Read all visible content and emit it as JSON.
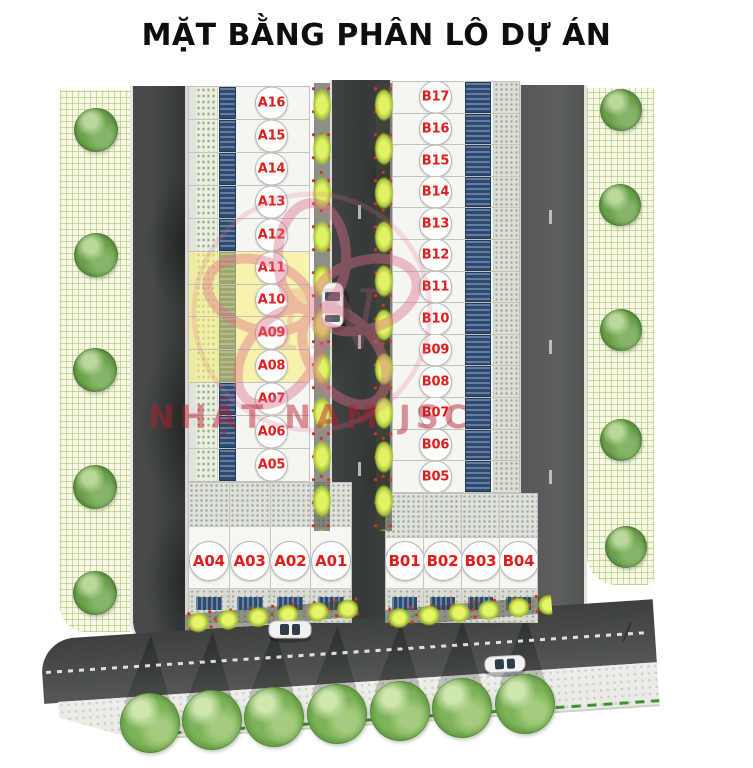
{
  "title": "MẶT BẰNG PHÂN LÔ DỰ ÁN",
  "watermark": {
    "text": "NHẬT NAM JSC",
    "monogram": "NN"
  },
  "blocks": {
    "block_a_column": {
      "lots": [
        "A16",
        "A15",
        "A14",
        "A13",
        "A12",
        "A11",
        "A10",
        "A09",
        "A08",
        "A07",
        "A06",
        "A05"
      ],
      "highlighted_lots": [
        "A11",
        "A10",
        "A09",
        "A08"
      ]
    },
    "block_a_row": {
      "lots": [
        "A04",
        "A03",
        "A02",
        "A01"
      ]
    },
    "block_b_column": {
      "lots": [
        "B17",
        "B16",
        "B15",
        "B14",
        "B13",
        "B12",
        "B11",
        "B10",
        "B09",
        "B08",
        "B07",
        "B06",
        "B05"
      ],
      "highlighted_lots": []
    },
    "block_b_row": {
      "lots": [
        "B01",
        "B02",
        "B03",
        "B04"
      ]
    }
  },
  "colors": {
    "lot_label": "#e01d1d",
    "lot_highlight": "#f7f076",
    "road": "#45484a",
    "grass": "#f7f9e7",
    "tree": "#5d9140",
    "hedge": "#c9dd4a",
    "roof_panel": "#2d4b72",
    "circle_border": "#b5b8b9"
  }
}
